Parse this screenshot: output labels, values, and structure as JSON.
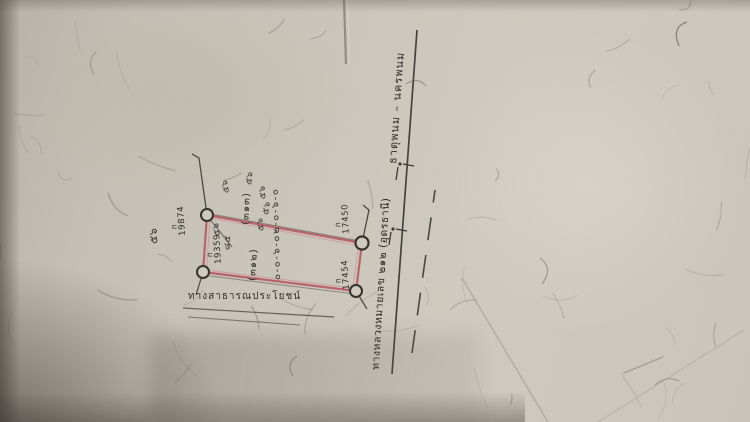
{
  "sketch": {
    "road": {
      "name": "ทางหลวงหมายเลข ๒๑๒ (อุดรธานี)",
      "route": "ธาตุพนม – นครพนม"
    },
    "lane": {
      "label": "ทางสาธารณประโยชน์"
    },
    "parcel": {
      "number": "(๓๑๒)",
      "area_chain": "๐-๐-๖-๐๒-๐-๖-๐",
      "markers": [
        {
          "prefix": "ก",
          "number": "19874"
        },
        {
          "prefix": "ก",
          "number": "19359"
        },
        {
          "prefix": "ก",
          "number": "17450"
        },
        {
          "prefix": "ก",
          "number": "17454"
        }
      ]
    },
    "neighbors": {
      "parcel_number": "(๓๑๓)",
      "scribbles": [
        "๕๖",
        "๕๖",
        "๕๖",
        "๕๖",
        "๕๖",
        "๘๕",
        "๕๖",
        "๕๖"
      ]
    },
    "colors": {
      "parcel_stroke": "#b4525c",
      "pencil_ink": "#44423c",
      "paper": "#cbc6bb"
    }
  }
}
